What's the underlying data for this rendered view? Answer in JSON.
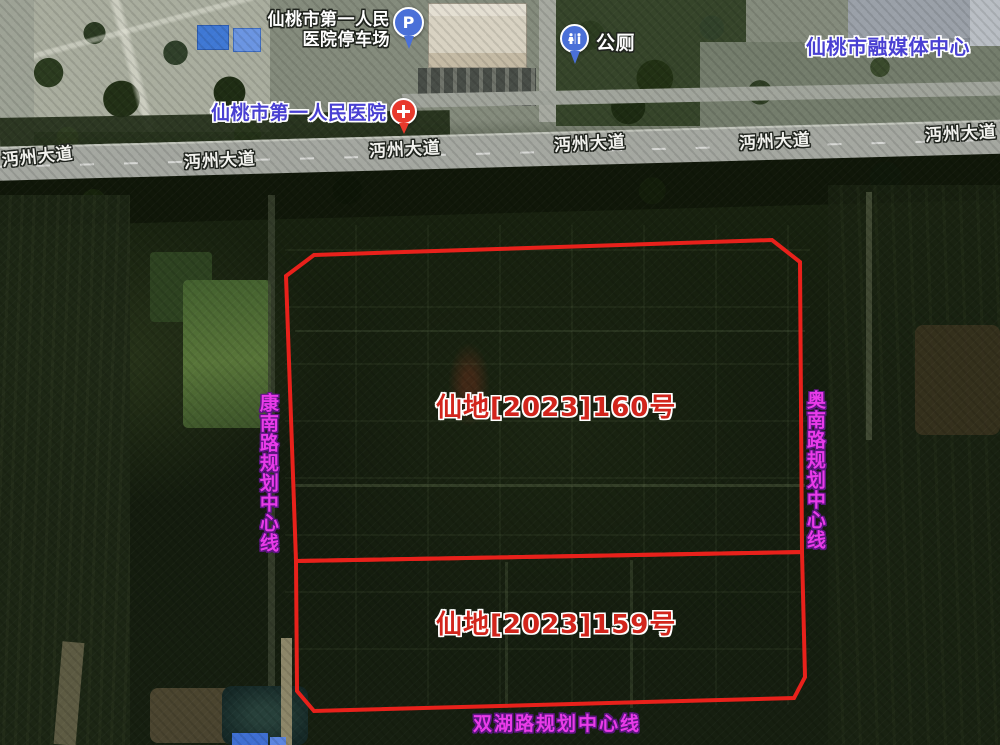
{
  "pois": {
    "parking": {
      "line1": "仙桃市第一人民",
      "line2": "医院停车场",
      "pin_letter": "P"
    },
    "toilet": {
      "label": "公厕"
    },
    "hospital": {
      "label": "仙桃市第一人民医院"
    },
    "media_center": {
      "label": "仙桃市融媒体中心"
    }
  },
  "roads": {
    "labels": [
      "沔州大道",
      "沔州大道",
      "沔州大道",
      "沔州大道",
      "沔州大道",
      "沔州大道"
    ]
  },
  "parcels": [
    {
      "label": "仙地[2023]160号"
    },
    {
      "label": "仙地[2023]159号"
    }
  ],
  "planning_lines": {
    "left": "康南路规划中心线",
    "right": "奥南路规划中心线",
    "bottom": "双湖路规划中心线"
  },
  "colors": {
    "boundary_red": "#e8211b",
    "parcel_label_red": "#d2251c",
    "planning_line_magenta": "#e93be9",
    "poi_blue_text": "#4940d2",
    "road_label_white": "#f2f2ee",
    "pin_blue": "#4a70d8",
    "pin_red": "#e8392c"
  }
}
